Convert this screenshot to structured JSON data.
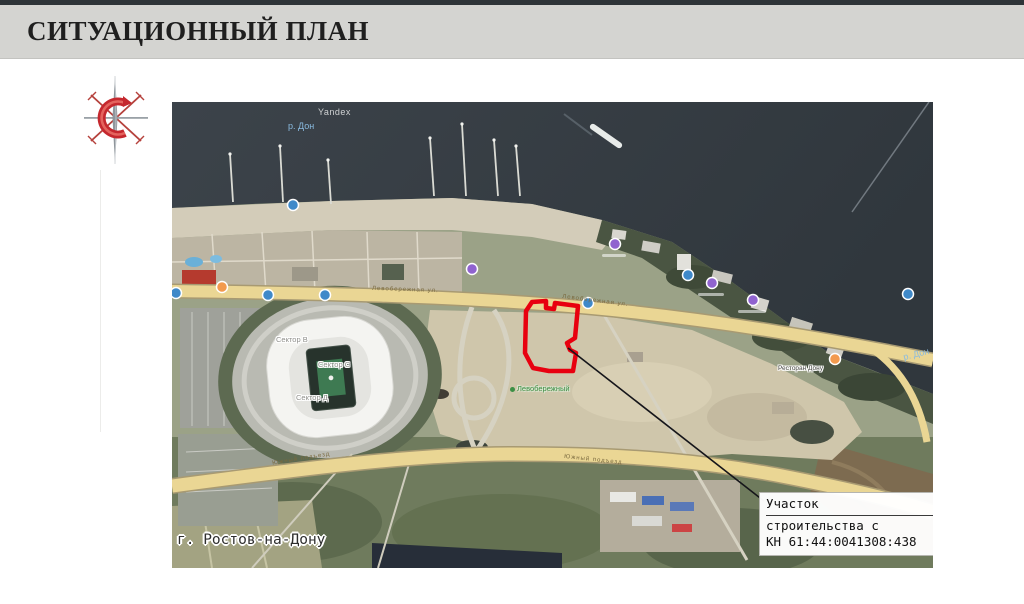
{
  "slide": {
    "title": "СИТУАЦИОННЫЙ ПЛАН"
  },
  "map": {
    "watermark": "Yandex",
    "river_label_1": "р. Дон",
    "river_label_2": "р. Дон",
    "city_label": "г. Ростов-на-Дону",
    "park_label": "Левобережный",
    "sector_label_1": "Сектор В",
    "sector_label_2": "Сектор С",
    "sector_label_3": "Сектор Д",
    "poi_label_restaurant": "Ресторан Дону",
    "road_label_upper_1": "Левобережная ул.",
    "road_label_upper_2": "Левобережная ул.",
    "road_label_lower_1": "Южный подъезд",
    "road_label_lower_2": "Южный подъезд",
    "callout": {
      "line1": "Участок",
      "line2": "строительства с",
      "line3": "КН 61:44:0041308:438"
    },
    "colors": {
      "plot_outline": "#e8000f",
      "leader_line": "#15151a",
      "water": "#373e45",
      "highway": "#ead694",
      "sand": "#cfc6ab",
      "poi_blue": "#3f89c9",
      "poi_purple": "#9063cf",
      "poi_orange": "#f29a4e"
    }
  }
}
